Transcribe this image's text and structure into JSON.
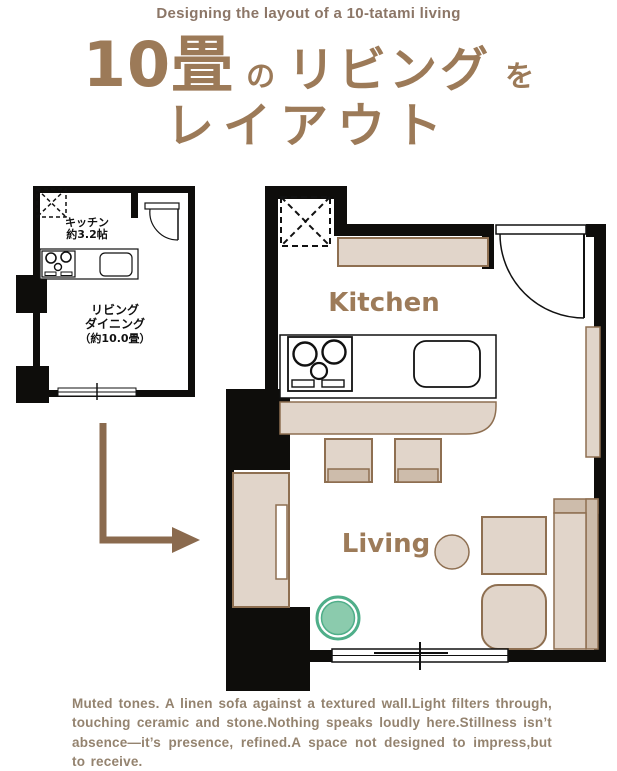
{
  "header": {
    "subtitle": "Designing the layout of a 10-tatami living"
  },
  "title": {
    "size": "10畳",
    "particle1": "の",
    "noun": "リビング",
    "particle2": "を",
    "line2": "レイアウト"
  },
  "before_plan": {
    "kitchen_label": "キッチン",
    "kitchen_area": "約3.2帖",
    "living_label": "リビング",
    "dining_label": "ダイニング",
    "living_area": "（約10.0畳）"
  },
  "after_plan": {
    "kitchen_label": "Kitchen",
    "living_label": "Living"
  },
  "caption": {
    "text": "Muted tones. A linen sofa against a textured wall.Light filters through, touching ceramic and stone.Nothing speaks loudly here.Stillness isn’t absence—it’s presence, refined.A space not designed to impress,but to receive."
  },
  "colors": {
    "title_brown": "#9c7a58",
    "subtitle_brown": "#8c7667",
    "caption_brown": "#94836f",
    "plan_label_brown": "#9d7b59",
    "wall_black": "#0e0d0b",
    "furniture_fill": "#e1d5ca",
    "furniture_fill_dark": "#cdbcab",
    "furniture_border": "#8e6f51",
    "plant_green_fill": "#8bcbad",
    "plant_green_border": "#4fae89",
    "arrow_brown": "#8a6a4e"
  },
  "icons": {
    "closet": "dashed-x-closet-icon",
    "stove": "stove-icon",
    "sink": "sink-icon",
    "door": "door-swing-icon",
    "window": "sliding-window-icon",
    "plant": "plant-icon",
    "arrow": "elbow-arrow-icon"
  }
}
